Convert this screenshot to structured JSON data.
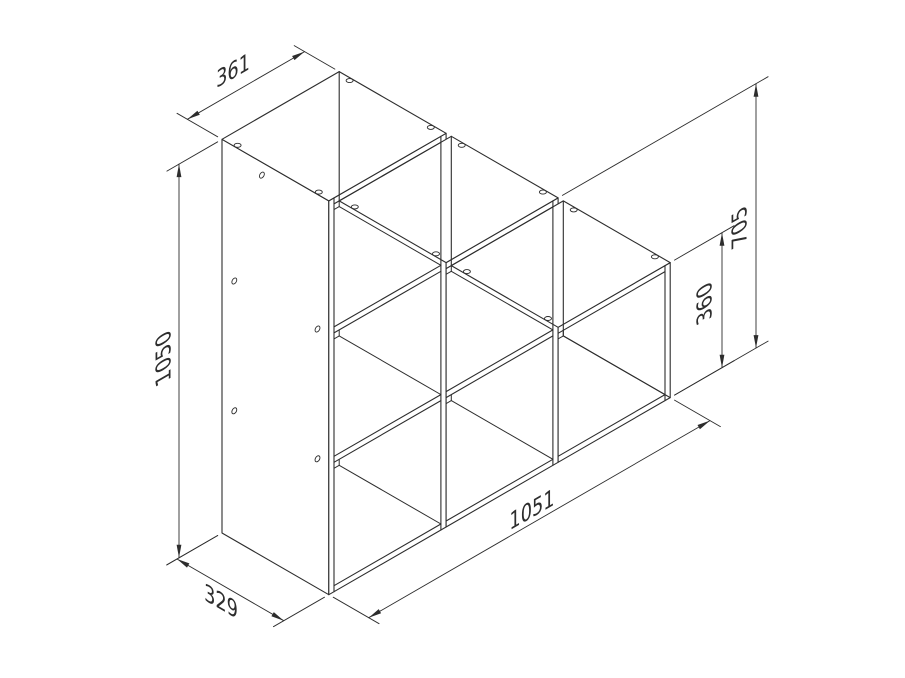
{
  "diagram": {
    "type": "isometric dimensioned technical drawing",
    "subject": "stepped open-cube storage shelf (3-2-1 cubes staircase)",
    "background_color": "#ffffff",
    "line_color": "#2d2d2d",
    "model": {
      "cube_inner": 329,
      "panel_thickness": 16,
      "depth": 329,
      "total_width": 1051,
      "column_heights": [
        1050,
        705,
        360
      ],
      "column_cubes": [
        3,
        2,
        1
      ]
    },
    "dimensions": [
      {
        "id": "top-cube-width",
        "label": "361"
      },
      {
        "id": "total-height",
        "label": "1050"
      },
      {
        "id": "base-depth",
        "label": "329"
      },
      {
        "id": "total-width",
        "label": "1051"
      },
      {
        "id": "two-cube-height",
        "label": "705"
      },
      {
        "id": "one-cube-height",
        "label": "360"
      }
    ]
  }
}
